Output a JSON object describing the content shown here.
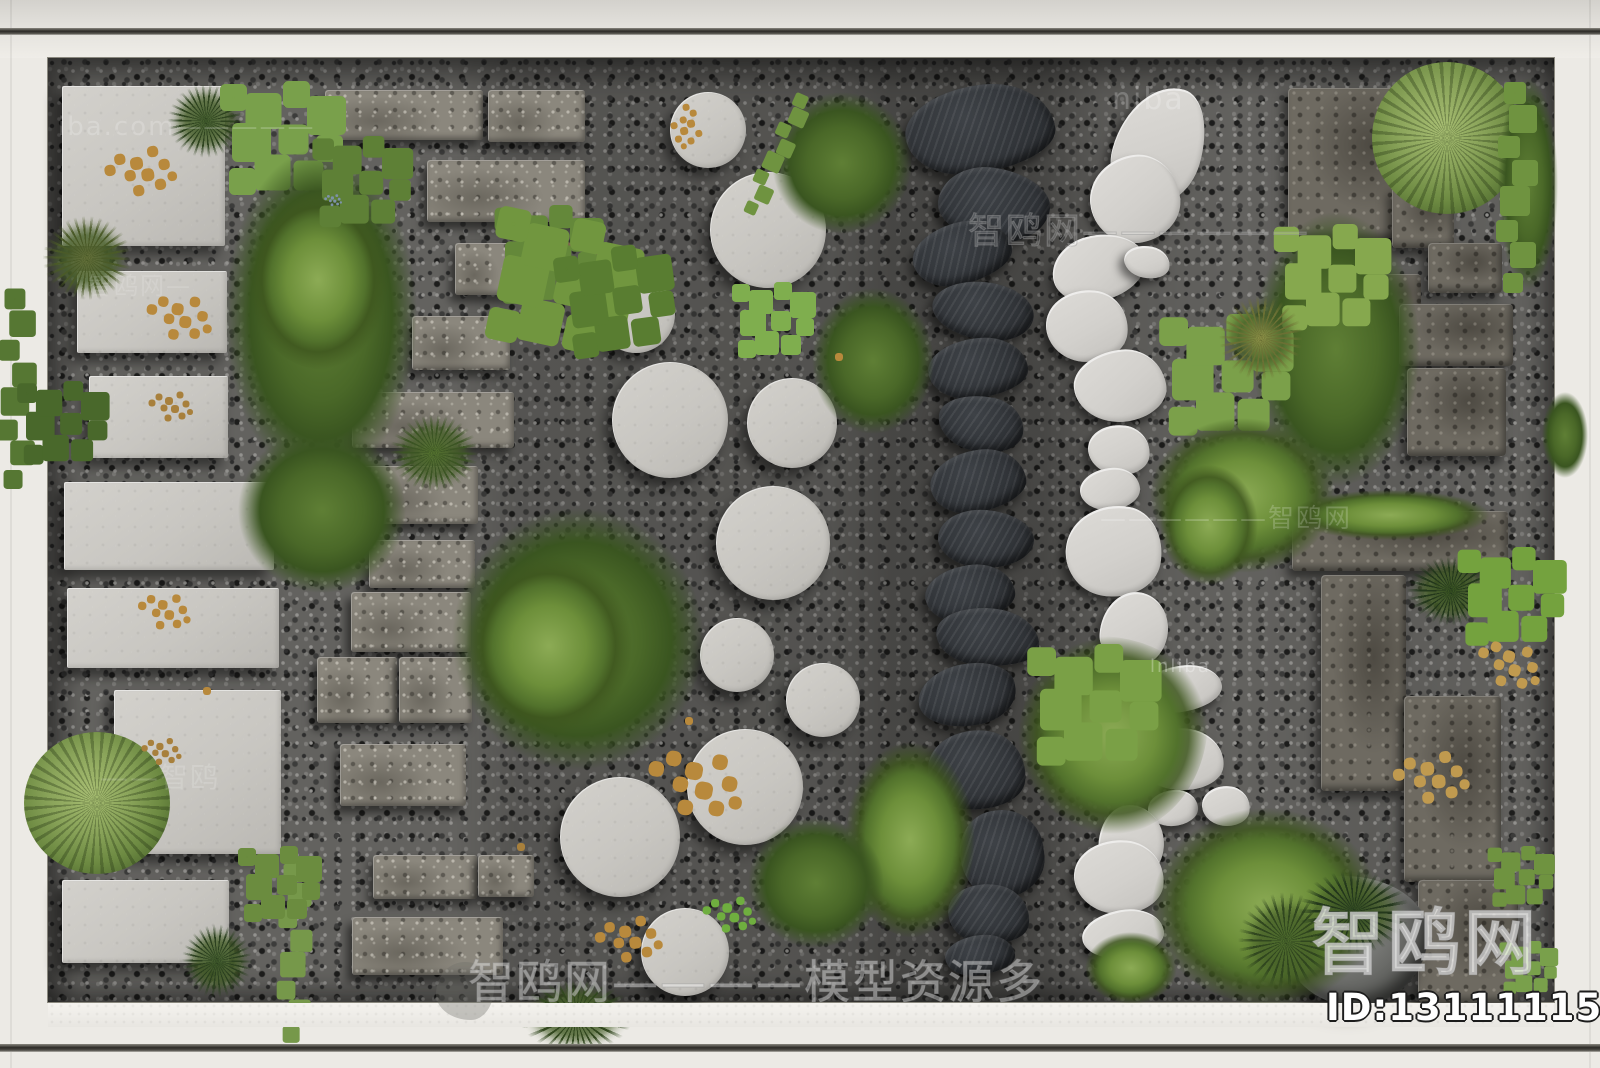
{
  "source_site": {
    "name": "智鸥网",
    "id_label": "ID:131111155"
  },
  "watermarks": {
    "top_left": "iba.com—————",
    "top_center": "niba",
    "right_band": "智鸥网——————",
    "right_mid": "——————智鸥网",
    "left_upper": "智鸥网—",
    "left_lower": "——智鸥",
    "center_small": "lnliba",
    "bottom_band": "智鸥网————模型资源多",
    "corner_logo": "智鸥网",
    "corner_id": "ID:131111155"
  },
  "scene": {
    "type": "top-down 3D render",
    "description": "White-framed courtyard garden material board: dark gravel bed with six vertical stepping walks — light concrete pavers with scattered seeds, weathered stone bricks, round concrete steps, black slate flags, white pebble steps, rustic stone slabs — interwoven with moss patches, shrubs, palms, ferns and groundcover",
    "columns": [
      "concrete-paver-walk",
      "stone-brick-walk",
      "round-concrete-steps",
      "black-slate-flags",
      "white-pebble-steps",
      "rustic-stone-slab-walk"
    ],
    "palette": {
      "frame_white": "#eceae5",
      "gravel_base": "#63625f",
      "gravel_dark": "#2e2e2e",
      "gravel_light": "#b3b2ae",
      "concrete_paver": "#c9c7c2",
      "pebble_white": "#d8d6d2",
      "slate_black": "#303438",
      "brick_gray": "#8b877d",
      "rustic_stone": "#6e6a61",
      "moss_bright": "#8cab55",
      "moss_mid": "#6d8f3a",
      "moss_dark": "#3a5520",
      "seed_gold": "#b8893c",
      "leaf_gold": "#c09a4f"
    }
  }
}
